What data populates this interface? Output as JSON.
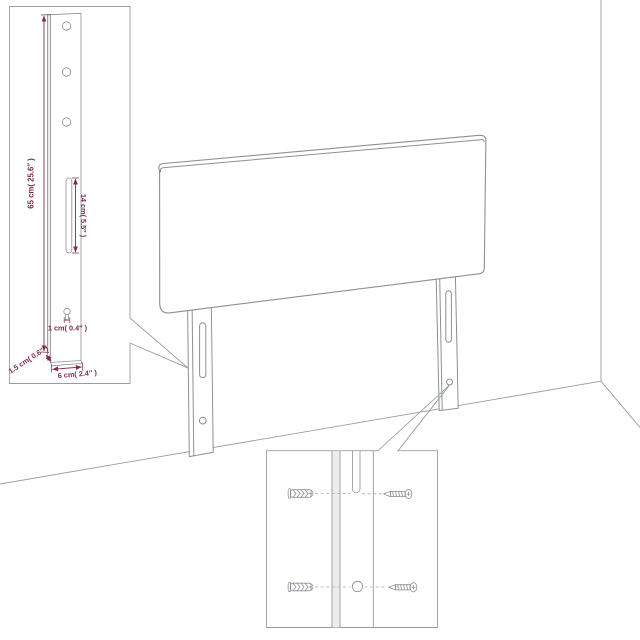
{
  "page": {
    "background": "#ffffff"
  },
  "diagram": {
    "kind": "product-dimension-diagram",
    "outline_color": "#8b9095",
    "dimension_color": "#7c2d4f",
    "leg_inset": {
      "height_label": "65 cm( 25.6″ )",
      "slot_label": "14 cm( 5.5″ )",
      "keyhole_label": "1 cm( 0.4″ )",
      "depth_label": "1.5 cm( 0.6″ )",
      "width_label": "6 cm( 2.4″ )",
      "hole_count": 3
    },
    "mounting_inset": {
      "rows": 2,
      "parts": [
        "wall-plug",
        "keyhole-slot",
        "screw",
        "wall-plug",
        "screw-hole",
        "screw"
      ]
    }
  }
}
